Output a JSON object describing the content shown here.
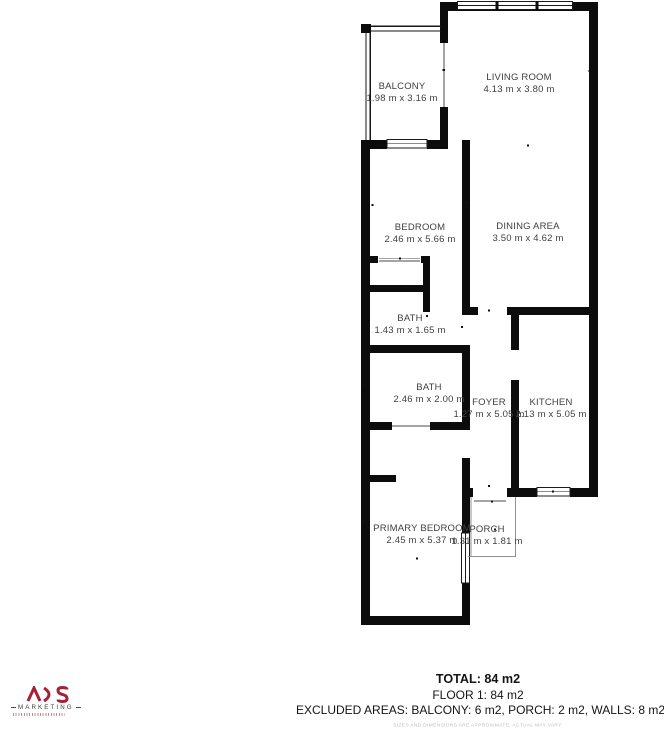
{
  "theme": {
    "accent": "#a52036",
    "wall_color": "#0c0c0c",
    "label_color": "#3f3f3f"
  },
  "floorplan": {
    "rooms": [
      {
        "id": "balcony",
        "name": "BALCONY",
        "dims": "1.98 m x 3.16 m"
      },
      {
        "id": "living-room",
        "name": "LIVING ROOM",
        "dims": "4.13 m x 3.80 m"
      },
      {
        "id": "bedroom",
        "name": "BEDROOM",
        "dims": "2.46 m x 5.66 m"
      },
      {
        "id": "dining-area",
        "name": "DINING AREA",
        "dims": "3.50 m x 4.62 m"
      },
      {
        "id": "bath-small",
        "name": "BATH",
        "dims": "1.43 m x 1.65 m"
      },
      {
        "id": "bath-large",
        "name": "BATH",
        "dims": "2.46 m x 2.00 m"
      },
      {
        "id": "foyer",
        "name": "FOYER",
        "dims": "1.27 m x 5.05 m"
      },
      {
        "id": "kitchen",
        "name": "KITCHEN",
        "dims": "2.13 m x 5.05 m"
      },
      {
        "id": "primary-bedroom",
        "name": "PRIMARY BEDROOM",
        "dims": "2.45 m x 5.37 m"
      },
      {
        "id": "porch",
        "name": "PORCH",
        "dims": "1.31 m x 1.81 m"
      }
    ]
  },
  "summary": {
    "total": "TOTAL: 84 m2",
    "floor": "FLOOR 1: 84 m2",
    "excluded": "EXCLUDED AREAS: BALCONY: 6 m2, PORCH: 2 m2, WALLS: 8 m2",
    "disclaimer": "SIZES AND DIMENSIONS ARE APPROXIMATE, ACTUAL MAY VARY."
  },
  "logo": {
    "name": "ADS",
    "sub": "MARKETING"
  }
}
